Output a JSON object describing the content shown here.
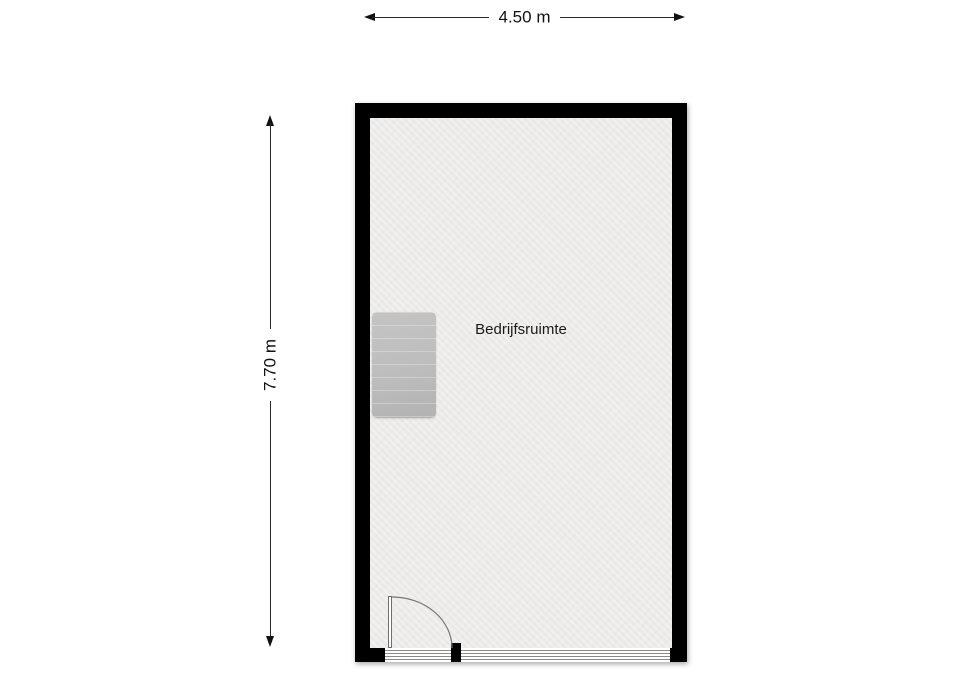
{
  "floor_plan": {
    "room": {
      "label": "Bedrijfsruimte"
    },
    "dimensions": {
      "width_label": "4.50 m",
      "height_label": "7.70 m"
    },
    "features": {
      "staircase": "stairs block against left wall",
      "door": "single door bottom-left opening inward",
      "glass_front": "glazed storefront along bottom wall"
    },
    "colors": {
      "wall": "#000000",
      "floor": "#ecebe9",
      "stairs": "#bdbdbd",
      "dimension_line": "#2a2a2a",
      "background": "#ffffff"
    }
  }
}
